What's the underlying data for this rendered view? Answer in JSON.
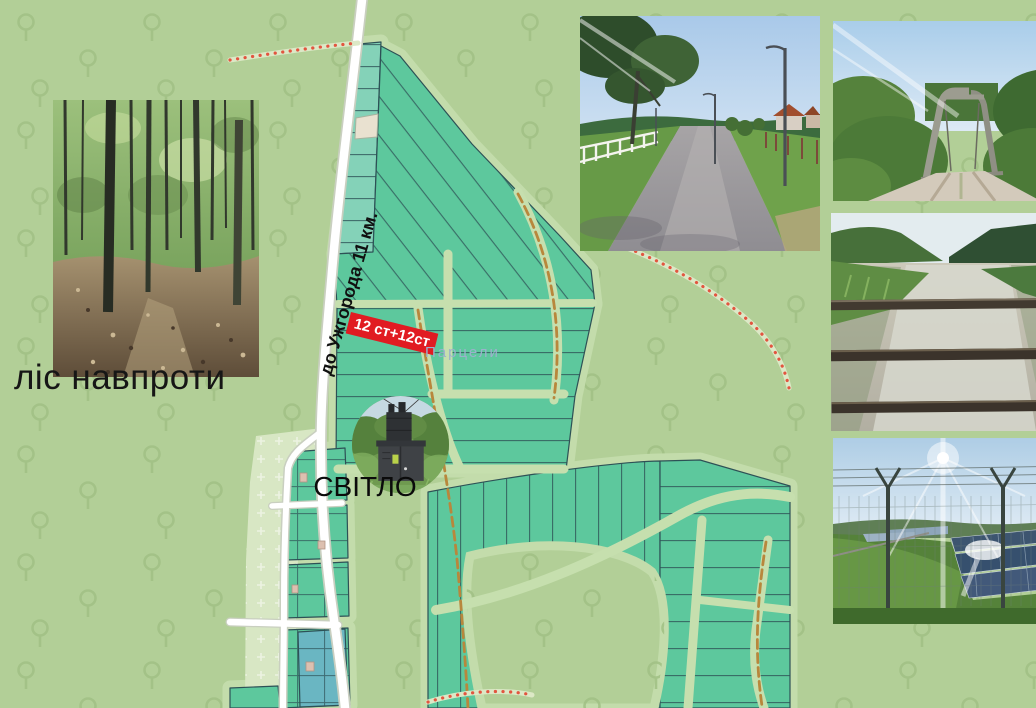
{
  "labels": {
    "road_distance": "до Ужгорода 11 км.",
    "plot_badge": "12 ст+12ст",
    "electricity_caption": "СВІТЛО",
    "forest_caption": "ліс навпроти",
    "map_area": "Парцели"
  },
  "map": {
    "background_color": "#b2cf97",
    "tree_icon_color": "#a0c084",
    "parcel_fill": "#5dc89d",
    "parcel_fill_light": "#84d2b8",
    "parcel_fill_blue": "#6ab6c2",
    "parcel_stroke": "#2d5156",
    "lane_color": "#c6dfae",
    "buffer_color": "#c3dcab",
    "road_color": "#ffffff",
    "road_casing_color": "#c9cfc0",
    "dirt_track_color": "#b8873c",
    "trail_dots_color": "#e2553f",
    "badge_background": "#e11b22",
    "badge_text_color": "#ffffff",
    "area_label_color": "#9bb1cc"
  },
  "photos": [
    {
      "name": "forest-photo",
      "subject": "forest"
    },
    {
      "name": "street-photo",
      "subject": "paved street with streetlights"
    },
    {
      "name": "bridge-photo",
      "subject": "gravel road over concrete bridge"
    },
    {
      "name": "canal-photo",
      "subject": "canal behind bridge railing"
    },
    {
      "name": "solar-photo",
      "subject": "solar power plant behind fence"
    },
    {
      "name": "transformer-photo",
      "subject": "electric transformer station"
    }
  ]
}
